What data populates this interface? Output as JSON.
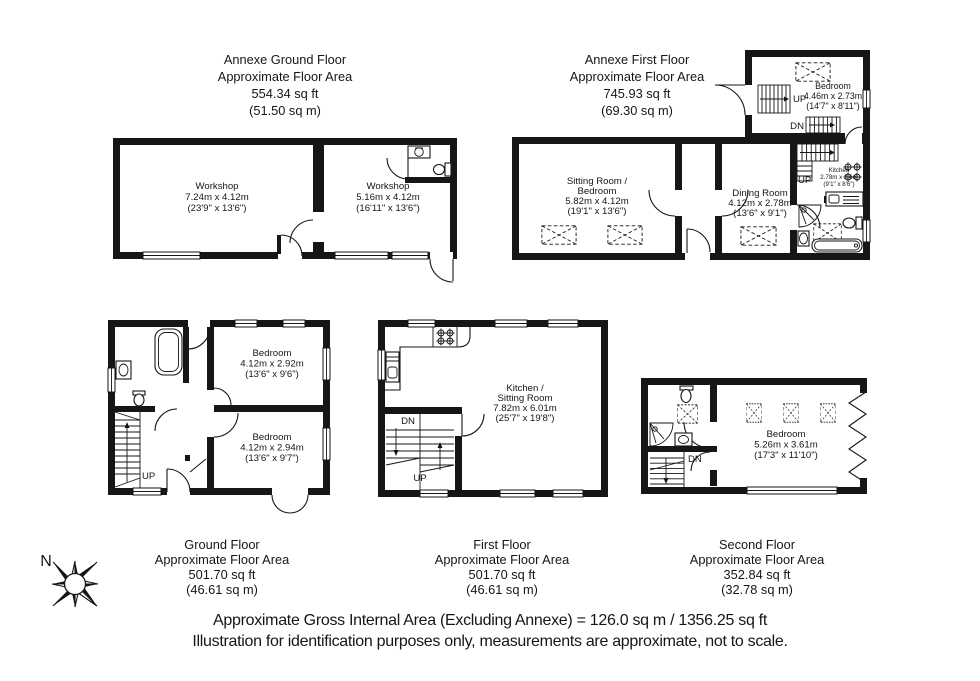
{
  "compass": {
    "north_label": "N"
  },
  "stairs": {
    "up": "UP",
    "down": "DN"
  },
  "floors": {
    "annexe_ground": {
      "title": [
        "Annexe Ground Floor",
        "Approximate Floor Area",
        "554.34 sq ft",
        "(51.50 sq m)"
      ],
      "rooms": {
        "workshop_large": {
          "name": "Workshop",
          "metric": "7.24m x 4.12m",
          "imperial": "(23'9\" x 13'6\")"
        },
        "workshop_small": {
          "name": "Workshop",
          "metric": "5.16m x 4.12m",
          "imperial": "(16'11\" x 13'6\")"
        }
      }
    },
    "annexe_first": {
      "title": [
        "Annexe First Floor",
        "Approximate Floor Area",
        "745.93 sq ft",
        "(69.30 sq m)"
      ],
      "rooms": {
        "bedroom": {
          "name": "Bedroom",
          "metric": "4.46m x 2.73m",
          "imperial": "(14'7\" x 8'11\")"
        },
        "sitting_bedroom": {
          "name_line1": "Sitting Room /",
          "name_line2": "Bedroom",
          "metric": "5.82m x 4.12m",
          "imperial": "(19'1\" x 13'6\")"
        },
        "dining": {
          "name": "Dining Room",
          "metric": "4.12m x 2.78m",
          "imperial": "(13'6\" x 9'1\")"
        },
        "kitchen": {
          "name": "Kitchen",
          "metric": "2.78m x 2.6m",
          "imperial": "(9'1\" x 8'6\")"
        }
      }
    },
    "ground": {
      "title": [
        "Ground Floor",
        "Approximate Floor Area",
        "501.70 sq ft",
        "(46.61 sq m)"
      ],
      "rooms": {
        "bedroom_front": {
          "name": "Bedroom",
          "metric": "4.12m x 2.92m",
          "imperial": "(13'6\" x 9'6\")"
        },
        "bedroom_back": {
          "name": "Bedroom",
          "metric": "4.12m x 2.94m",
          "imperial": "(13'6\" x 9'7\")"
        }
      }
    },
    "first": {
      "title": [
        "First Floor",
        "Approximate Floor Area",
        "501.70 sq ft",
        "(46.61 sq m)"
      ],
      "rooms": {
        "kitchen_sitting": {
          "name_line1": "Kitchen /",
          "name_line2": "Sitting Room",
          "metric": "7.82m x 6.01m",
          "imperial": "(25'7\" x 19'8\")"
        }
      }
    },
    "second": {
      "title": [
        "Second Floor",
        "Approximate Floor Area",
        "352.84 sq ft",
        "(32.78 sq m)"
      ],
      "rooms": {
        "bedroom": {
          "name": "Bedroom",
          "metric": "5.26m x 3.61m",
          "imperial": "(17'3\" x 11'10\")"
        }
      }
    }
  },
  "footer": {
    "line1": "Approximate Gross Internal Area (Excluding Annexe) = 126.0 sq m / 1356.25 sq ft",
    "line2": "Illustration for identification purposes only, measurements are approximate, not to scale."
  }
}
